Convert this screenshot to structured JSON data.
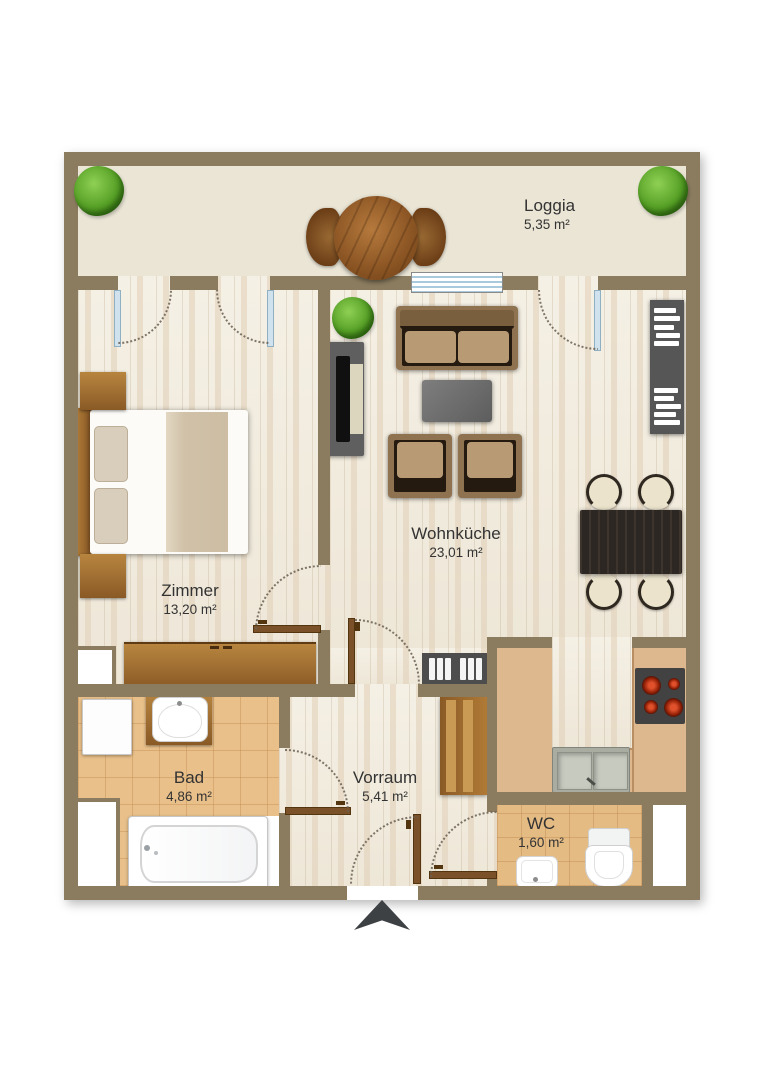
{
  "rooms": {
    "loggia": {
      "name": "Loggia",
      "area": "5,35 m²"
    },
    "zimmer": {
      "name": "Zimmer",
      "area": "13,20 m²"
    },
    "wohnkueche": {
      "name": "Wohnküche",
      "area": "23,01 m²"
    },
    "vorraum": {
      "name": "Vorraum",
      "area": "5,41 m²"
    },
    "bad": {
      "name": "Bad",
      "area": "4,86 m²"
    },
    "wc": {
      "name": "WC",
      "area": "1,60 m²"
    }
  },
  "furniture": {
    "loggia": [
      "round-table",
      "chair",
      "chair",
      "tree",
      "tree"
    ],
    "zimmer": [
      "double-bed",
      "nightstand",
      "nightstand",
      "wardrobe"
    ],
    "wohnkueche": [
      "sofa",
      "coffee-table",
      "armchair",
      "armchair",
      "tv-board",
      "bookshelf",
      "plant",
      "dining-table",
      "dining-chairs",
      "shoe-cabinet",
      "kitchen-counter",
      "cooktop",
      "double-sink"
    ],
    "vorraum": [
      "wardrobe"
    ],
    "bad": [
      "washing-machine",
      "washbasin-vanity",
      "bathtub"
    ],
    "wc": [
      "toilet",
      "hand-basin"
    ]
  },
  "colors": {
    "wall": "#8b7c5f",
    "wood_floor": "#f2ecdf",
    "loggia_floor": "#eae5d5",
    "bath_tile": "#e9c08a",
    "wc_tile": "#e5bb84",
    "kitchen_counter": "#d8b087",
    "furniture_wood": "#a9742f",
    "label_text": "#333333"
  }
}
